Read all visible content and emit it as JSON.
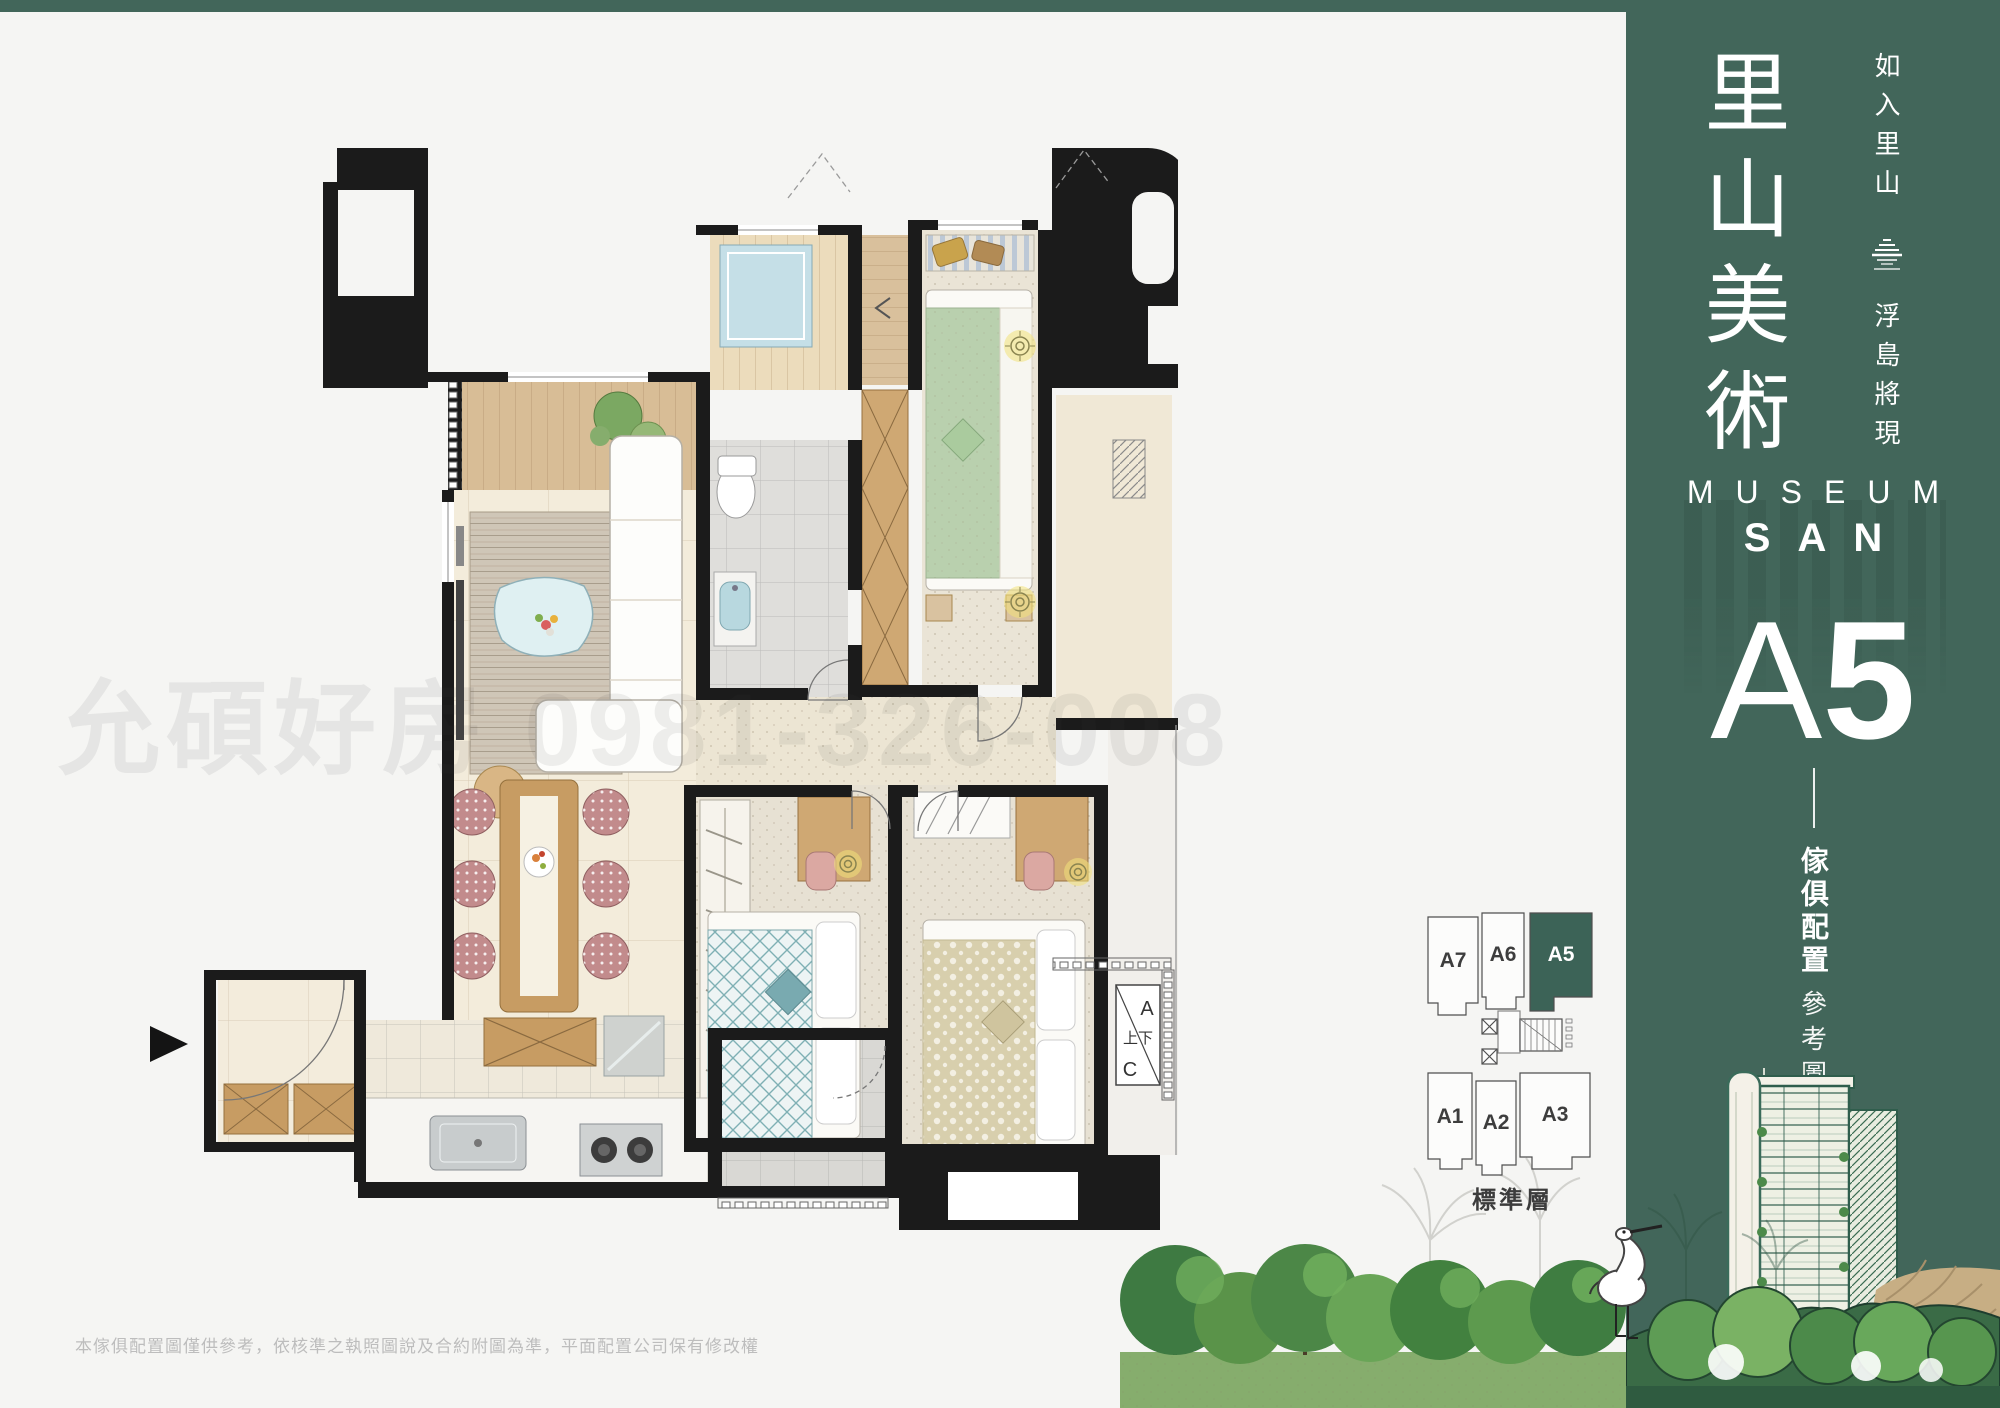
{
  "colors": {
    "panel_green": "#42665A",
    "keyplan_highlight": "#3C6357",
    "card_bg": "#F5F5F3",
    "wall_black": "#1B1B1B",
    "marble_floor": "#F3ECDB",
    "wood": "#C79C63",
    "tile_gray": "#D9D8D4",
    "accent_aqua": "#C5DFE7",
    "teal_bedding": "#7FA8AC",
    "light_symbol_yellow": "#F2E27A",
    "tree_green": "#4C8747",
    "watermark_gray": "rgba(70,70,70,0.085)"
  },
  "sidebar": {
    "title_vertical": "里山美術",
    "tagline_top": "如入里山",
    "tagline_bottom": "浮島將現",
    "logo_icon": "layered-island-icon",
    "brand_line1": "MUSEUM",
    "brand_line2": "SAN",
    "unit_letter": "A",
    "unit_number": "5",
    "caption_primary": "傢俱配置",
    "caption_secondary": "參考圖"
  },
  "keyplan": {
    "floor_label": "標準層",
    "units": [
      {
        "id": "A7",
        "highlighted": false
      },
      {
        "id": "A6",
        "highlighted": false
      },
      {
        "id": "A5",
        "highlighted": true
      },
      {
        "id": "A1",
        "highlighted": false
      },
      {
        "id": "A2",
        "highlighted": false
      },
      {
        "id": "A3",
        "highlighted": false
      }
    ]
  },
  "floorplan": {
    "watermark": "允碩好房 0981-326-008",
    "stair_box": {
      "top_letter": "A",
      "middle_text": "上下",
      "bottom_letter": "C"
    }
  },
  "footer": {
    "disclaimer": "本傢俱配置圖僅供參考，依核準之執照圖說及合約附圖為準，平面配置公司保有修改權"
  }
}
